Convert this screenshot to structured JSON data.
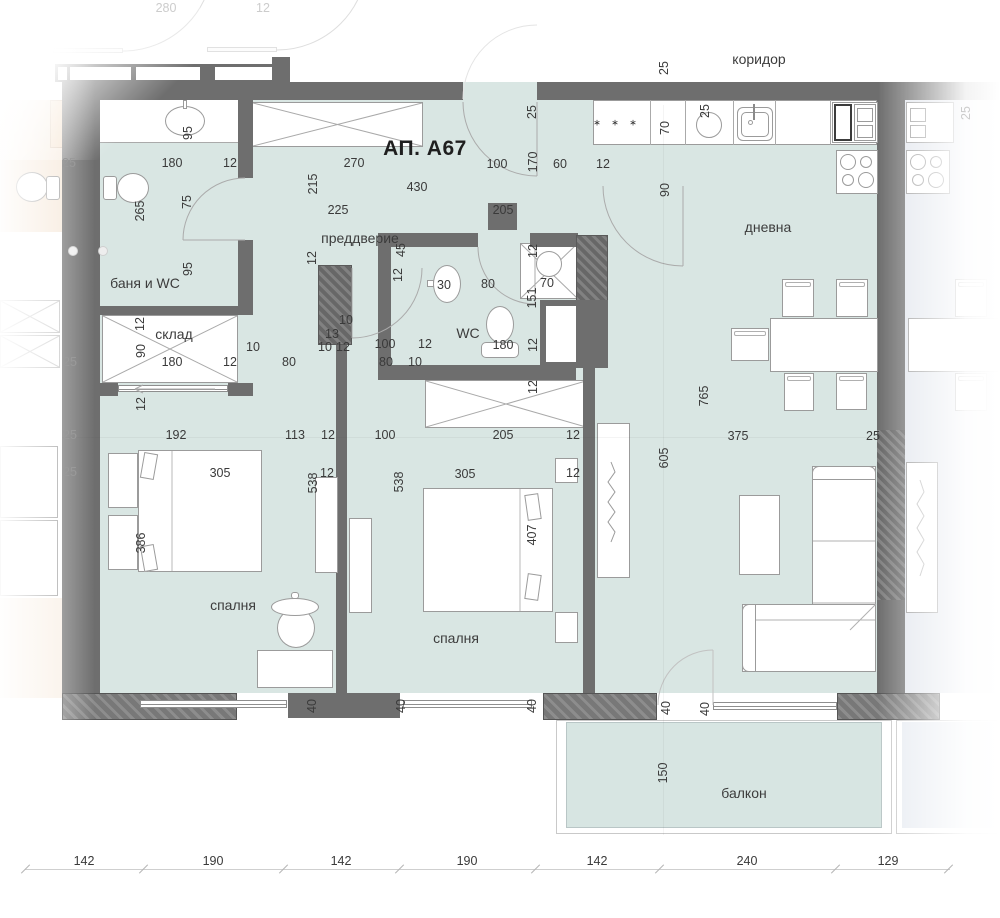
{
  "title": "АП. А67",
  "corridor_label": "коридор",
  "rooms": [
    "коридор",
    "преддверие",
    "баня и WC",
    "склад",
    "WC",
    "дневна",
    "спалня",
    "спалня",
    "балкон"
  ],
  "bottom_scale_cm": [
    142,
    190,
    142,
    190,
    142,
    240,
    129
  ],
  "colors": {
    "floor": "#d9e6e3",
    "wall": "#6e6e6e",
    "neighbor_left_floor": "#f6e8d9",
    "neighbor_right_floor": "#e3e7ee",
    "dimension_text": "#3a3a3a"
  },
  "labels": [
    {
      "t": "280",
      "x": 166,
      "y": 8,
      "c": "f"
    },
    {
      "t": "12",
      "x": 263,
      "y": 8,
      "c": "f"
    },
    {
      "t": "коридор",
      "x": 759,
      "y": 59,
      "c": "r"
    },
    {
      "t": "25",
      "x": 664,
      "y": 68,
      "c": "dv"
    },
    {
      "t": "25",
      "x": 966,
      "y": 113,
      "c": "fv"
    },
    {
      "t": "95",
      "x": 188,
      "y": 133,
      "c": "dv"
    },
    {
      "t": "180",
      "x": 172,
      "y": 163,
      "c": "d"
    },
    {
      "t": "12",
      "x": 230,
      "y": 163,
      "c": "d"
    },
    {
      "t": "25",
      "x": 69,
      "y": 163,
      "c": "m"
    },
    {
      "t": "270",
      "x": 354,
      "y": 163,
      "c": "d"
    },
    {
      "t": "100",
      "x": 497,
      "y": 164,
      "c": "d"
    },
    {
      "t": "170",
      "x": 533,
      "y": 162,
      "c": "dv"
    },
    {
      "t": "60",
      "x": 560,
      "y": 164,
      "c": "d"
    },
    {
      "t": "12",
      "x": 603,
      "y": 164,
      "c": "d"
    },
    {
      "t": "25",
      "x": 532,
      "y": 112,
      "c": "dv"
    },
    {
      "t": "∗ ∗ ∗",
      "x": 617,
      "y": 123,
      "c": "s"
    },
    {
      "t": "70",
      "x": 665,
      "y": 128,
      "c": "dv"
    },
    {
      "t": "25",
      "x": 705,
      "y": 111,
      "c": "dv"
    },
    {
      "t": "90",
      "x": 665,
      "y": 190,
      "c": "dv"
    },
    {
      "t": "АП. А67",
      "x": 425,
      "y": 149,
      "c": "t"
    },
    {
      "t": "215",
      "x": 313,
      "y": 184,
      "c": "dv"
    },
    {
      "t": "430",
      "x": 417,
      "y": 187,
      "c": "d"
    },
    {
      "t": "265",
      "x": 140,
      "y": 211,
      "c": "dv"
    },
    {
      "t": "75",
      "x": 187,
      "y": 202,
      "c": "dv"
    },
    {
      "t": "225",
      "x": 338,
      "y": 210,
      "c": "d"
    },
    {
      "t": "205",
      "x": 503,
      "y": 210,
      "c": "d"
    },
    {
      "t": "преддверие",
      "x": 360,
      "y": 238,
      "c": "r"
    },
    {
      "t": "дневна",
      "x": 768,
      "y": 227,
      "c": "r"
    },
    {
      "t": "12",
      "x": 312,
      "y": 258,
      "c": "dv"
    },
    {
      "t": "45",
      "x": 401,
      "y": 250,
      "c": "dv"
    },
    {
      "t": "12",
      "x": 398,
      "y": 275,
      "c": "dv"
    },
    {
      "t": "30",
      "x": 444,
      "y": 285,
      "c": "d"
    },
    {
      "t": "80",
      "x": 488,
      "y": 284,
      "c": "d"
    },
    {
      "t": "12",
      "x": 533,
      "y": 251,
      "c": "dv"
    },
    {
      "t": "70",
      "x": 547,
      "y": 283,
      "c": "d"
    },
    {
      "t": "151",
      "x": 532,
      "y": 298,
      "c": "dv"
    },
    {
      "t": "95",
      "x": 188,
      "y": 269,
      "c": "dv"
    },
    {
      "t": "баня и WC",
      "x": 145,
      "y": 283,
      "c": "r"
    },
    {
      "t": "12",
      "x": 140,
      "y": 324,
      "c": "dv"
    },
    {
      "t": "склад",
      "x": 174,
      "y": 334,
      "c": "r"
    },
    {
      "t": "90",
      "x": 141,
      "y": 351,
      "c": "dv"
    },
    {
      "t": "WC",
      "x": 468,
      "y": 333,
      "c": "r"
    },
    {
      "t": "180",
      "x": 503,
      "y": 345,
      "c": "d"
    },
    {
      "t": "12",
      "x": 533,
      "y": 345,
      "c": "dv"
    },
    {
      "t": "13",
      "x": 332,
      "y": 334,
      "c": "d"
    },
    {
      "t": "10",
      "x": 346,
      "y": 320,
      "c": "d"
    },
    {
      "t": "10",
      "x": 325,
      "y": 347,
      "c": "d"
    },
    {
      "t": "12",
      "x": 343,
      "y": 347,
      "c": "d"
    },
    {
      "t": "100",
      "x": 385,
      "y": 344,
      "c": "d"
    },
    {
      "t": "12",
      "x": 425,
      "y": 344,
      "c": "d"
    },
    {
      "t": "80",
      "x": 386,
      "y": 362,
      "c": "d"
    },
    {
      "t": "10",
      "x": 415,
      "y": 362,
      "c": "d"
    },
    {
      "t": "10",
      "x": 253,
      "y": 347,
      "c": "d"
    },
    {
      "t": "25",
      "x": 70,
      "y": 362,
      "c": "m"
    },
    {
      "t": "180",
      "x": 172,
      "y": 362,
      "c": "d"
    },
    {
      "t": "12",
      "x": 230,
      "y": 362,
      "c": "d"
    },
    {
      "t": "80",
      "x": 289,
      "y": 362,
      "c": "d"
    },
    {
      "t": "12",
      "x": 141,
      "y": 404,
      "c": "dv"
    },
    {
      "t": "12",
      "x": 533,
      "y": 387,
      "c": "dv"
    },
    {
      "t": "25",
      "x": 70,
      "y": 435,
      "c": "m"
    },
    {
      "t": "192",
      "x": 176,
      "y": 435,
      "c": "d"
    },
    {
      "t": "113",
      "x": 295,
      "y": 435,
      "c": "d"
    },
    {
      "t": "12",
      "x": 328,
      "y": 435,
      "c": "d"
    },
    {
      "t": "100",
      "x": 385,
      "y": 435,
      "c": "d"
    },
    {
      "t": "205",
      "x": 503,
      "y": 435,
      "c": "d"
    },
    {
      "t": "12",
      "x": 573,
      "y": 435,
      "c": "d"
    },
    {
      "t": "375",
      "x": 738,
      "y": 436,
      "c": "d"
    },
    {
      "t": "25",
      "x": 873,
      "y": 436,
      "c": "d"
    },
    {
      "t": "765",
      "x": 704,
      "y": 396,
      "c": "dv"
    },
    {
      "t": "605",
      "x": 664,
      "y": 458,
      "c": "dv"
    },
    {
      "t": "25",
      "x": 70,
      "y": 472,
      "c": "m"
    },
    {
      "t": "305",
      "x": 220,
      "y": 473,
      "c": "d"
    },
    {
      "t": "12",
      "x": 327,
      "y": 473,
      "c": "d"
    },
    {
      "t": "538",
      "x": 313,
      "y": 483,
      "c": "dv"
    },
    {
      "t": "305",
      "x": 465,
      "y": 474,
      "c": "d"
    },
    {
      "t": "12",
      "x": 573,
      "y": 473,
      "c": "d"
    },
    {
      "t": "538",
      "x": 399,
      "y": 482,
      "c": "dv"
    },
    {
      "t": "386",
      "x": 141,
      "y": 543,
      "c": "dv"
    },
    {
      "t": "407",
      "x": 532,
      "y": 535,
      "c": "dv"
    },
    {
      "t": "спалня",
      "x": 233,
      "y": 605,
      "c": "r"
    },
    {
      "t": "спалня",
      "x": 456,
      "y": 638,
      "c": "r"
    },
    {
      "t": "40",
      "x": 312,
      "y": 706,
      "c": "dv"
    },
    {
      "t": "40",
      "x": 401,
      "y": 706,
      "c": "dv"
    },
    {
      "t": "40",
      "x": 532,
      "y": 706,
      "c": "dv"
    },
    {
      "t": "40",
      "x": 666,
      "y": 708,
      "c": "dv"
    },
    {
      "t": "40",
      "x": 705,
      "y": 709,
      "c": "dv"
    },
    {
      "t": "150",
      "x": 663,
      "y": 773,
      "c": "dv"
    },
    {
      "t": "балкон",
      "x": 744,
      "y": 793,
      "c": "r"
    },
    {
      "t": "142",
      "x": 84,
      "y": 861,
      "c": "d"
    },
    {
      "t": "190",
      "x": 213,
      "y": 861,
      "c": "d"
    },
    {
      "t": "142",
      "x": 341,
      "y": 861,
      "c": "d"
    },
    {
      "t": "190",
      "x": 467,
      "y": 861,
      "c": "d"
    },
    {
      "t": "142",
      "x": 597,
      "y": 861,
      "c": "d"
    },
    {
      "t": "240",
      "x": 747,
      "y": 861,
      "c": "d"
    },
    {
      "t": "129",
      "x": 888,
      "y": 861,
      "c": "d"
    }
  ]
}
